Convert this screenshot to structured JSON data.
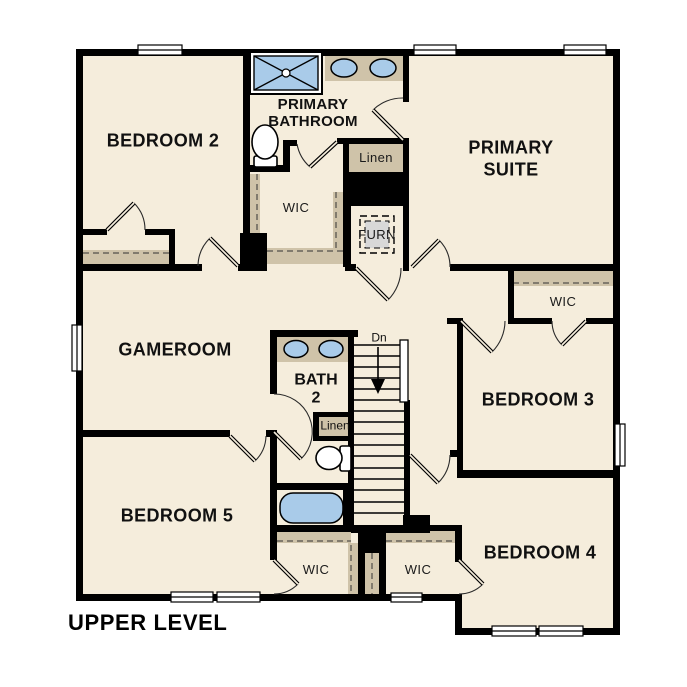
{
  "plan": {
    "title": "UPPER LEVEL",
    "rooms": {
      "bedroom2": "BEDROOM 2",
      "primary_bathroom_line1": "PRIMARY",
      "primary_bathroom_line2": "BATHROOM",
      "primary_suite_line1": "PRIMARY",
      "primary_suite_line2": "SUITE",
      "gameroom": "GAMEROOM",
      "bath2_line1": "BATH",
      "bath2_line2": "2",
      "bedroom3": "BEDROOM 3",
      "bedroom4": "BEDROOM 4",
      "bedroom5": "BEDROOM 5"
    },
    "closets": {
      "wic": "WIC",
      "linen": "Linen",
      "furnace": "FURN"
    },
    "stairs": {
      "direction": "Dn"
    },
    "colors": {
      "floor": "#f5eddc",
      "wall": "#000000",
      "shelf": "#cfc3a9",
      "fixture_blue": "#a9cbe9",
      "furnace_gray": "#d8d8d8"
    }
  }
}
